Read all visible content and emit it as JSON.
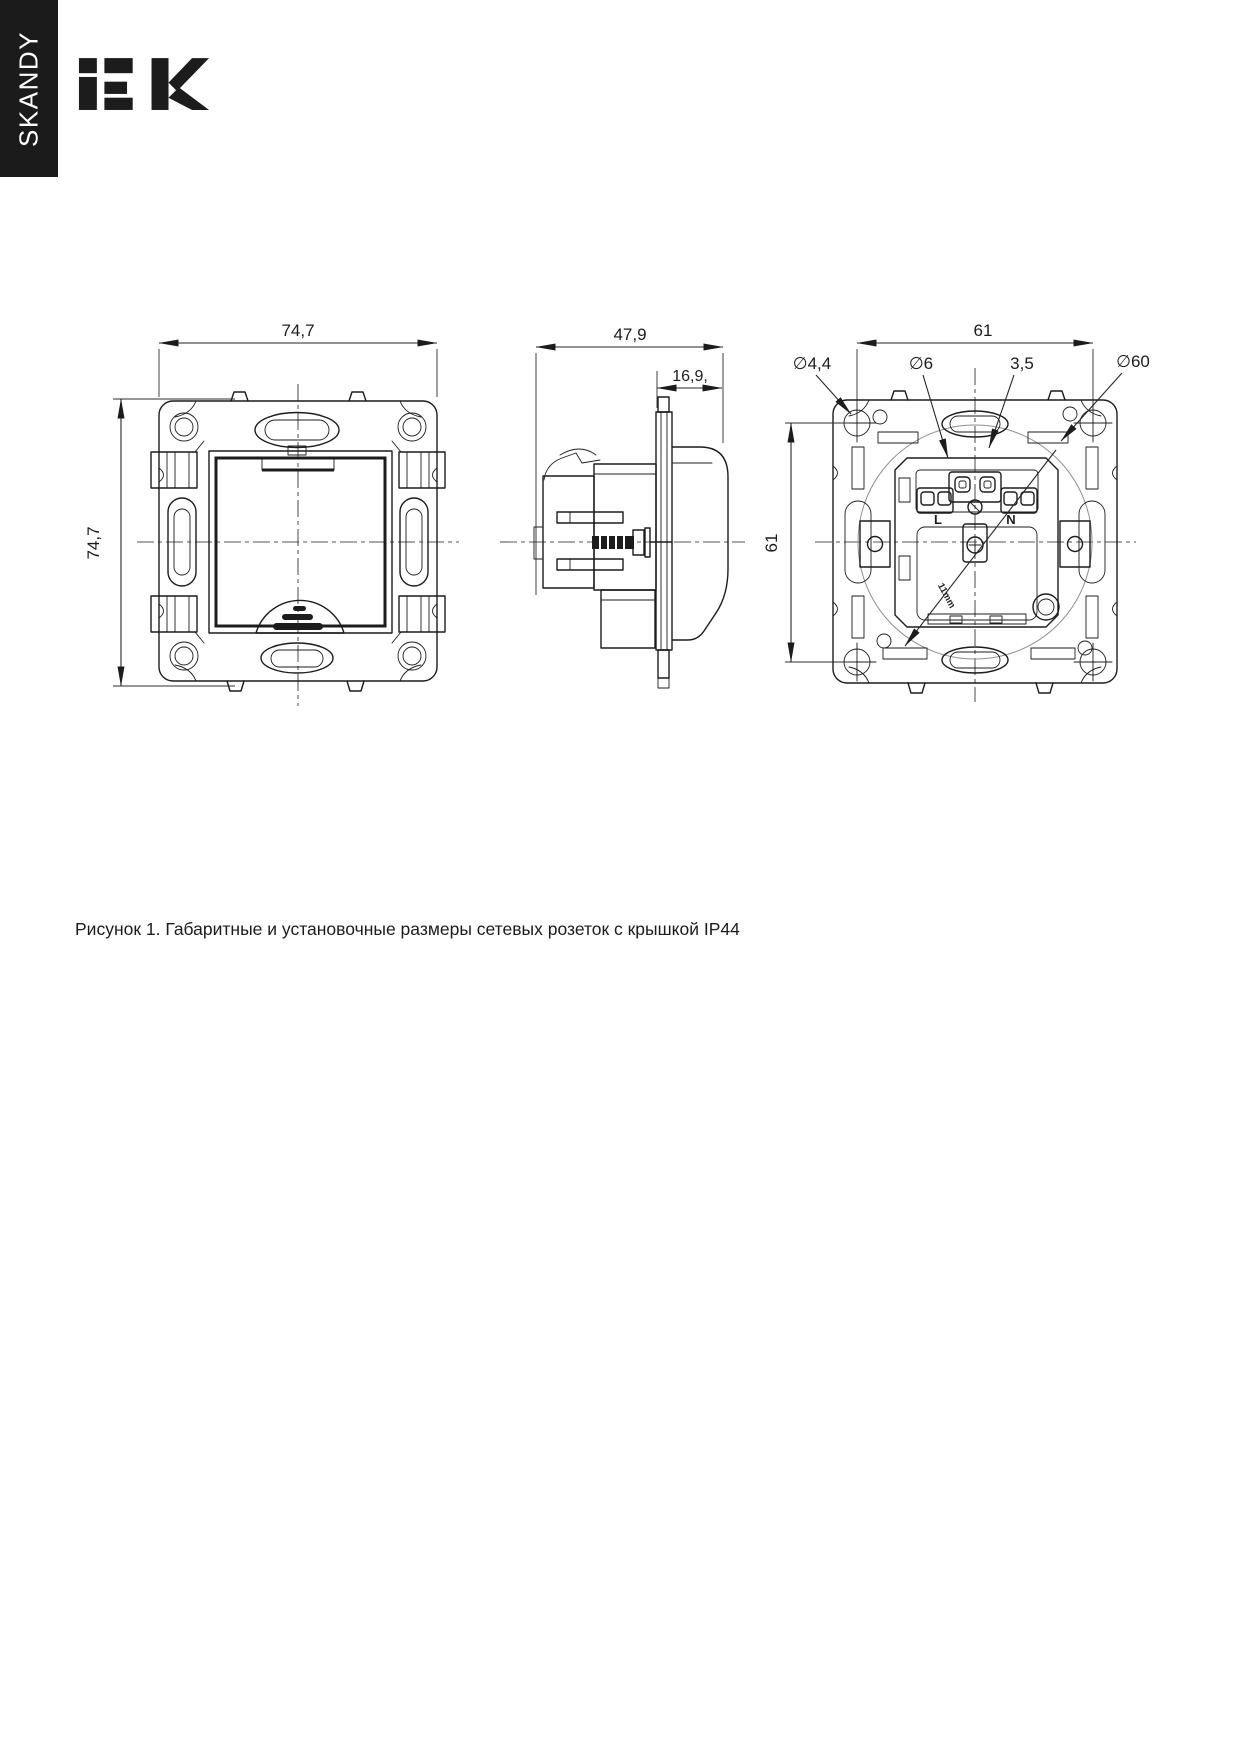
{
  "colors": {
    "ink": "#1c1c1c",
    "page_bg": "#ffffff",
    "tab_bg": "#1b1b1b",
    "tab_text": "#ffffff",
    "aux_circle": "#8e8e8e"
  },
  "header": {
    "series_tab": "SKANDY",
    "brand_logo": "iEK"
  },
  "figure": {
    "front": {
      "dim_width": "74,7",
      "dim_height": "74,7"
    },
    "side": {
      "dim_depth": "47,9",
      "dim_front_depth": "16,9,"
    },
    "rear": {
      "dim_width": "61",
      "dim_height": "61",
      "dia_screw_hole": "∅4,4",
      "dia_hole": "∅6",
      "dim_slot": "3,5",
      "dia_box": "∅60",
      "terminal_live": "L",
      "terminal_neutral": "N",
      "strip_note": "11mm"
    }
  },
  "caption": {
    "text": "Рисунок 1. Габаритные и установочные размеры сетевых розеток с крышкой IP44"
  }
}
